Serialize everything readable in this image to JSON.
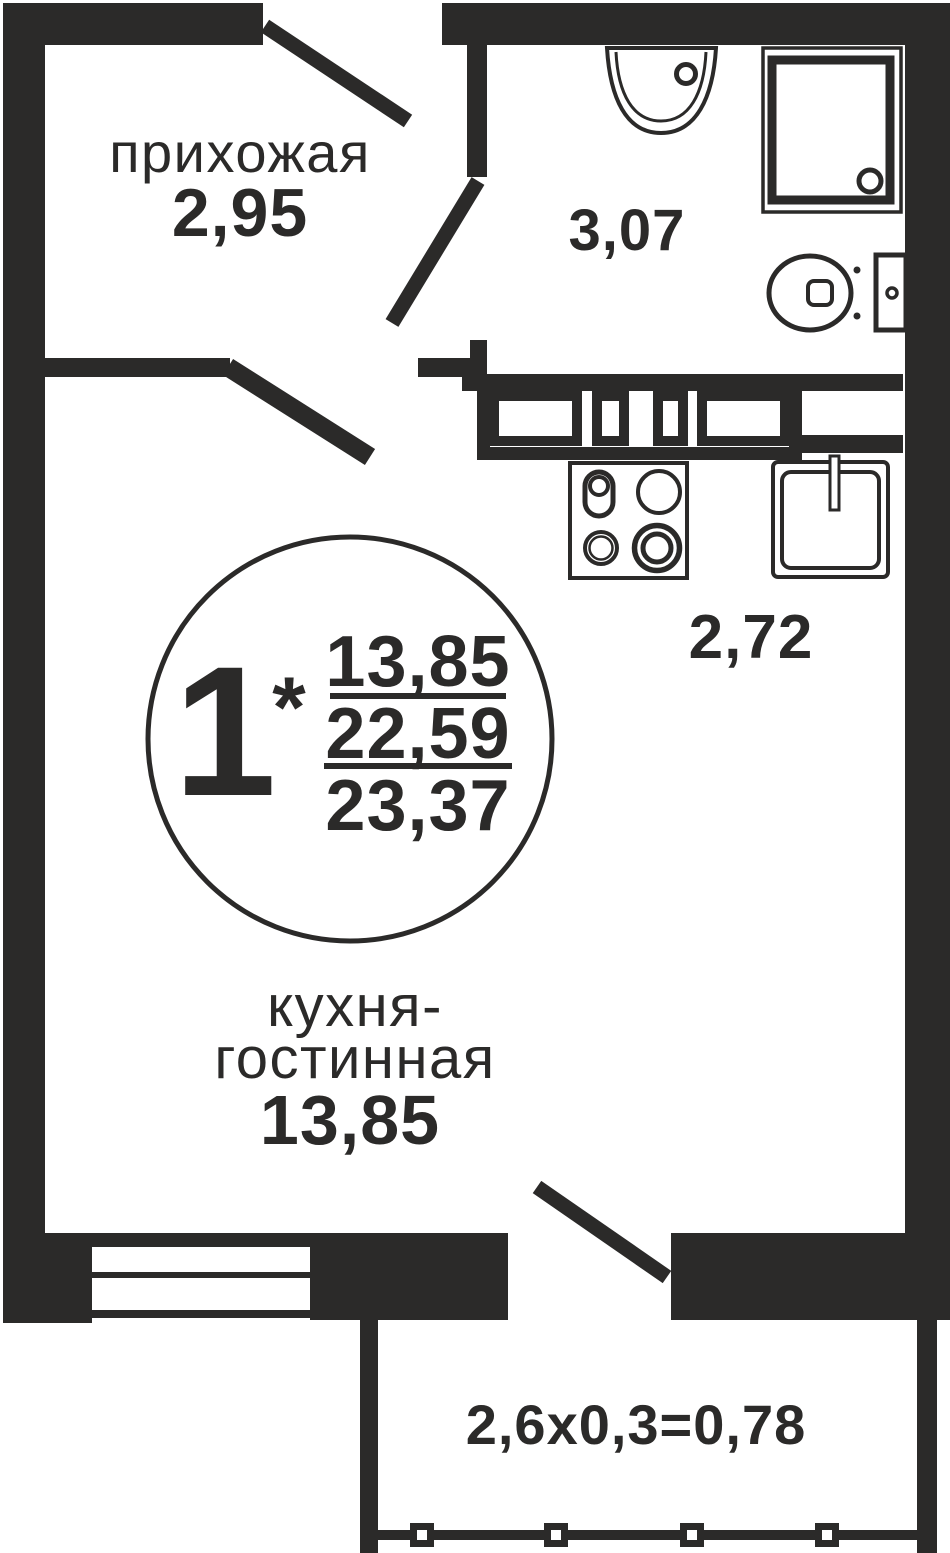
{
  "colors": {
    "ink": "#2b2a29",
    "paper": "#ffffff"
  },
  "rooms": {
    "hallway": {
      "label": "прихожая",
      "area": "2,95"
    },
    "bathroom": {
      "area": "3,07"
    },
    "kitchen_zone": {
      "area": "2,72"
    },
    "kitchen_living": {
      "label_line1": "кухня-",
      "label_line2": "гостинная",
      "area": "13,85"
    },
    "balcony": {
      "dimensions": "2,6x0,3=0,78"
    }
  },
  "stamp": {
    "room_count": "1",
    "asterisk": "*",
    "living_area": "13,85",
    "apartment_area": "22,59",
    "total_area": "23,37"
  },
  "icons": [
    "bathroom-sink-icon",
    "shower-icon",
    "toilet-icon",
    "kitchen-cabinets-icon",
    "stove-icon",
    "kitchen-sink-icon",
    "window-icon",
    "balcony-railing-icon",
    "entrance-door-icon",
    "bathroom-door-icon",
    "balcony-door-icon"
  ]
}
